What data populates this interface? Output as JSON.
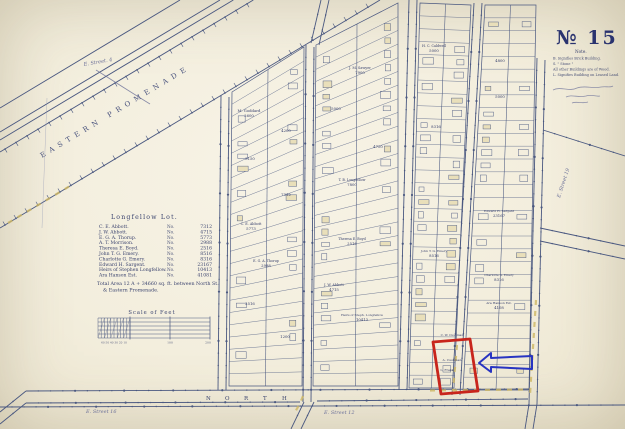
{
  "colors": {
    "paper": "#f3eedd",
    "ink": "#4a5880",
    "ink_dark": "#353f68",
    "accent_red": "#c8251c",
    "accent_blue": "#2834c2",
    "highlight_yellow": "#cdb763"
  },
  "title": {
    "sheet": "№ 15"
  },
  "legend": {
    "heading": "Note.",
    "lines": [
      "B. Signifies Brick Building.",
      "S.      \"      Stone      \"",
      "All other Buildings are of Wood.",
      "L. Signifies Building on Leased Land."
    ]
  },
  "owners": {
    "title": "Longfellow Lot.",
    "no_abbrev": "No.",
    "rows": [
      {
        "name": "C. E. Abbott.",
        "area": "7312"
      },
      {
        "name": "J. W. Abbott.",
        "area": "4715"
      },
      {
        "name": "E. G. A. Thorup.",
        "area": "5773"
      },
      {
        "name": "A. T. Morrison.",
        "area": "2988"
      },
      {
        "name": "Theresa E. Boyd.",
        "area": "2516"
      },
      {
        "name": "John T. G. Emery.",
        "area": "8516"
      },
      {
        "name": "Charlotte G. Emery.",
        "area": "8316"
      },
      {
        "name": "Edward H. Sargent.",
        "area": "23167"
      },
      {
        "name": "Heirs of Stephen Longfellow.",
        "area": "10413"
      },
      {
        "name": "Ara Hanson Est.",
        "area": "41081"
      }
    ],
    "total_line1": "Total Area  12 A + 34660 sq. ft. between North St.",
    "total_line2": "& Eastern Promenade."
  },
  "scale_bar": {
    "label": "Scale of Feet",
    "left_ticks": "60 50 40 30 20 10",
    "mid": "100",
    "right": "200"
  },
  "streets": {
    "promenade": "EASTERN   PROMENADE",
    "north_letters": [
      "N",
      "O",
      "R",
      "T",
      "H"
    ],
    "hand_labels": [
      {
        "text": "E. Street. 4",
        "x": 84,
        "y": 66,
        "r": -10
      },
      {
        "text": "E. Street 16",
        "x": 86,
        "y": 413,
        "r": 0
      },
      {
        "text": "E. Street 12",
        "x": 324,
        "y": 414,
        "r": 0
      },
      {
        "text": "E. Street 19",
        "x": 560,
        "y": 198,
        "r": -72
      }
    ]
  },
  "lot_labels": [
    {
      "t": "M. Goddard",
      "x": 249,
      "y": 112
    },
    {
      "t": "2600",
      "x": 249,
      "y": 117
    },
    {
      "t": "4200",
      "x": 286,
      "y": 132
    },
    {
      "t": "3150",
      "x": 250,
      "y": 160
    },
    {
      "t": "7312",
      "x": 286,
      "y": 196
    },
    {
      "t": "C. E. Abbott",
      "x": 251,
      "y": 225,
      "s": 3.4
    },
    {
      "t": "5773",
      "x": 251,
      "y": 230
    },
    {
      "t": "E. G. A. Thorup",
      "x": 266,
      "y": 262,
      "s": 3.3
    },
    {
      "t": "2988",
      "x": 266,
      "y": 267
    },
    {
      "t": "2516",
      "x": 250,
      "y": 305
    },
    {
      "t": "1200",
      "x": 285,
      "y": 338
    },
    {
      "t": "J. M. Sawyer",
      "x": 360,
      "y": 69,
      "s": 3.4
    },
    {
      "t": "7900",
      "x": 360,
      "y": 74
    },
    {
      "t": "5000",
      "x": 336,
      "y": 110
    },
    {
      "t": "4750",
      "x": 378,
      "y": 148
    },
    {
      "t": "T. B. Longfellow",
      "x": 352,
      "y": 181,
      "s": 3.3
    },
    {
      "t": "7800",
      "x": 352,
      "y": 186
    },
    {
      "t": "Theresa E. Boyd",
      "x": 352,
      "y": 240,
      "s": 3.3
    },
    {
      "t": "2516",
      "x": 352,
      "y": 245
    },
    {
      "t": "J. W. Abbott",
      "x": 334,
      "y": 286,
      "s": 3.4
    },
    {
      "t": "4715",
      "x": 334,
      "y": 291
    },
    {
      "t": "Heirs of Steph. Longfellow",
      "x": 362,
      "y": 316,
      "s": 3.1
    },
    {
      "t": "10413",
      "x": 362,
      "y": 321
    },
    {
      "t": "H. C. Caldwell",
      "x": 434,
      "y": 47,
      "s": 3.3
    },
    {
      "t": "5000",
      "x": 434,
      "y": 52
    },
    {
      "t": "8316",
      "x": 436,
      "y": 128
    },
    {
      "t": "John T. G. Emery",
      "x": 434,
      "y": 252,
      "s": 3.1
    },
    {
      "t": "8516",
      "x": 434,
      "y": 257
    },
    {
      "t": "C. W. Cushman",
      "x": 452,
      "y": 336,
      "s": 3
    },
    {
      "t": "A. Cushman",
      "x": 452,
      "y": 361,
      "s": 3.1
    },
    {
      "t": "L. Frank",
      "x": 447,
      "y": 371,
      "s": 3.1
    },
    {
      "t": "4800",
      "x": 500,
      "y": 62
    },
    {
      "t": "5000",
      "x": 500,
      "y": 98
    },
    {
      "t": "Edward H. Sargent",
      "x": 499,
      "y": 212,
      "s": 3.1
    },
    {
      "t": "23167",
      "x": 499,
      "y": 217
    },
    {
      "t": "Charlotte G. Emery",
      "x": 499,
      "y": 276,
      "s": 3
    },
    {
      "t": "8316",
      "x": 499,
      "y": 281
    },
    {
      "t": "Ara Hanson Est.",
      "x": 499,
      "y": 304,
      "s": 3.1
    },
    {
      "t": "4108",
      "x": 499,
      "y": 309
    }
  ]
}
